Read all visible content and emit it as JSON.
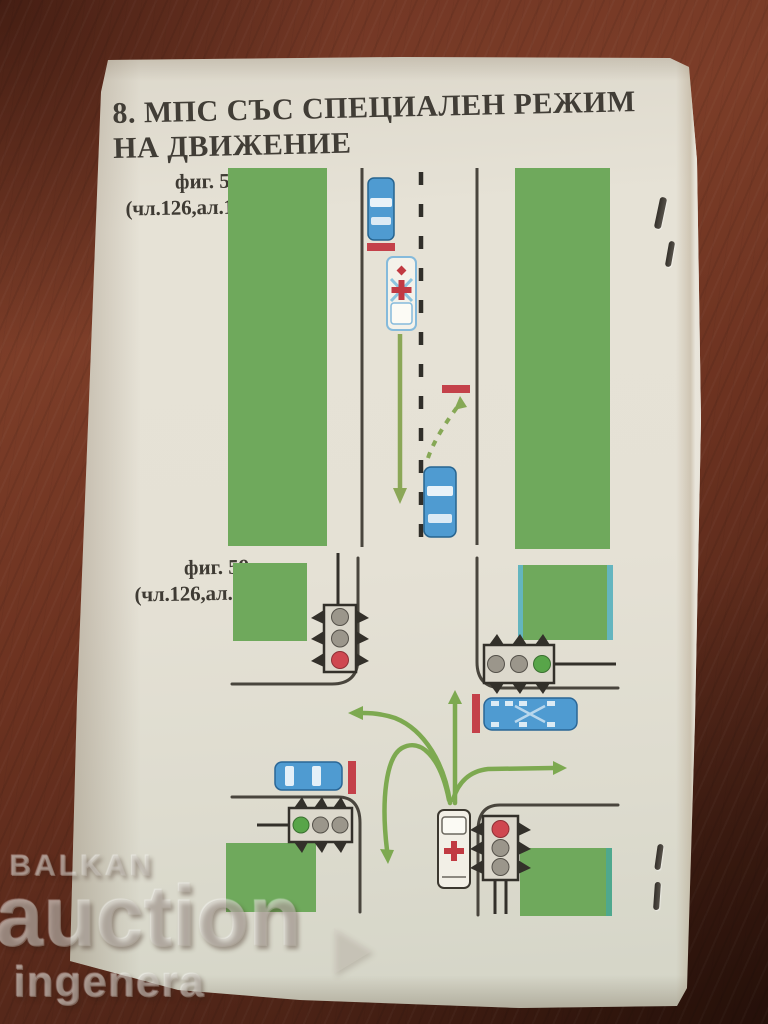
{
  "photo": {
    "watermark": {
      "brand": "BALKAN",
      "word": "auction",
      "subtitle": "ingenera"
    }
  },
  "page": {
    "heading": {
      "line1": "8. МПС СЪС СПЕЦИАЛЕН РЕЖИМ",
      "line2": "НА ДВИЖЕНИЕ"
    },
    "figures": [
      {
        "label": "фиг. 58",
        "article_ref": "(чл.126,ал.1)",
        "diagram": {
          "type": "road-scene",
          "road": "straight two-lane road, dashed center line, grass strips both sides",
          "vehicles": [
            {
              "type": "car",
              "color": "blue",
              "state": "stopped before red stop line, left lane, facing down"
            },
            {
              "type": "ambulance",
              "color": "white",
              "state": "priority vehicle proceeding straight, solid green arrow"
            },
            {
              "type": "car",
              "color": "blue",
              "state": "oncoming, pulls aside to edge, dashed green arrow to red stop line"
            }
          ]
        }
      },
      {
        "label": "фиг. 59",
        "article_ref": "(чл.126,ал.2)",
        "diagram": {
          "type": "intersection-scene",
          "traffic_lights": [
            {
              "corner": "top-left",
              "orientation": "vertical",
              "lit": "red"
            },
            {
              "corner": "top-right",
              "orientation": "horizontal",
              "lit": "green"
            },
            {
              "corner": "bottom-left",
              "orientation": "horizontal",
              "lit": "green"
            },
            {
              "corner": "bottom-right",
              "orientation": "vertical",
              "lit": "red"
            }
          ],
          "vehicles": [
            {
              "type": "bus",
              "color": "blue",
              "state": "stopped at red stop line, right approach"
            },
            {
              "type": "car",
              "color": "blue",
              "state": "stopped at red stop line, left approach"
            },
            {
              "type": "ambulance",
              "color": "white",
              "state": "green arrows allow straight, left, right and U-turn"
            }
          ]
        }
      }
    ]
  },
  "colors": {
    "table_wood": "#6e3423",
    "paper": "#e3dfd3",
    "grass_green": "#6fa95c",
    "arrow_green": "#7da950",
    "vehicle_blue": "#4f9bd1",
    "stop_line_red": "#c4414a",
    "signal_red": "#cf4750",
    "signal_green": "#58a549"
  }
}
